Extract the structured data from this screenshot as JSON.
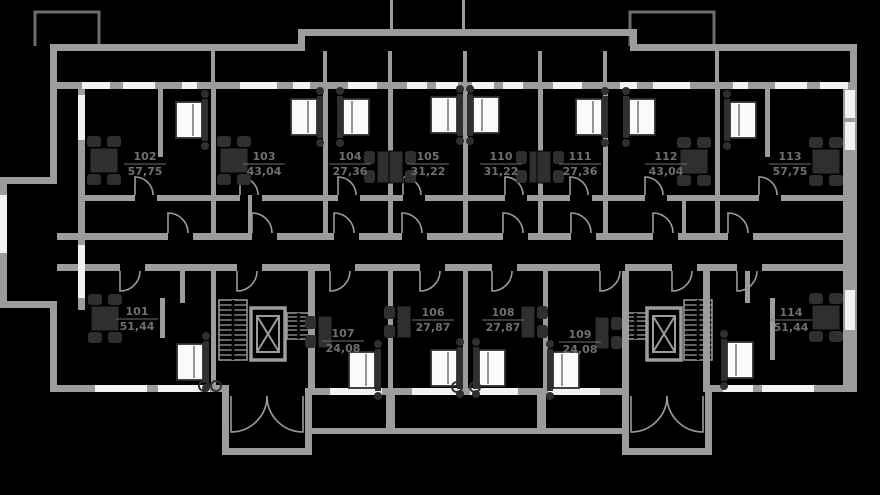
{
  "plan": {
    "type": "residential-floor-plan",
    "apartments": [
      {
        "number": "101",
        "area": "51,44"
      },
      {
        "number": "102",
        "area": "57,75"
      },
      {
        "number": "103",
        "area": "43,04"
      },
      {
        "number": "104",
        "area": "27,36"
      },
      {
        "number": "105",
        "area": "31,22"
      },
      {
        "number": "106",
        "area": "27,87"
      },
      {
        "number": "107",
        "area": "24,08"
      },
      {
        "number": "108",
        "area": "27,87"
      },
      {
        "number": "109",
        "area": "24,08"
      },
      {
        "number": "110",
        "area": "31,22"
      },
      {
        "number": "111",
        "area": "27,36"
      },
      {
        "number": "112",
        "area": "43,04"
      },
      {
        "number": "113",
        "area": "57,75"
      },
      {
        "number": "114",
        "area": "51,44"
      }
    ],
    "features": [
      "staircase-left",
      "elevator-left",
      "staircase-right",
      "elevator-right",
      "entrance-porch-left",
      "entrance-porch-right"
    ],
    "colors": {
      "background": "#000000",
      "wall": "#9c9c9c",
      "window": "#f2f2f2",
      "furniture": "#2f2f2f",
      "bed": "#fafafa",
      "label": "#6f6f6f",
      "outline": "#6e6e6e"
    }
  }
}
